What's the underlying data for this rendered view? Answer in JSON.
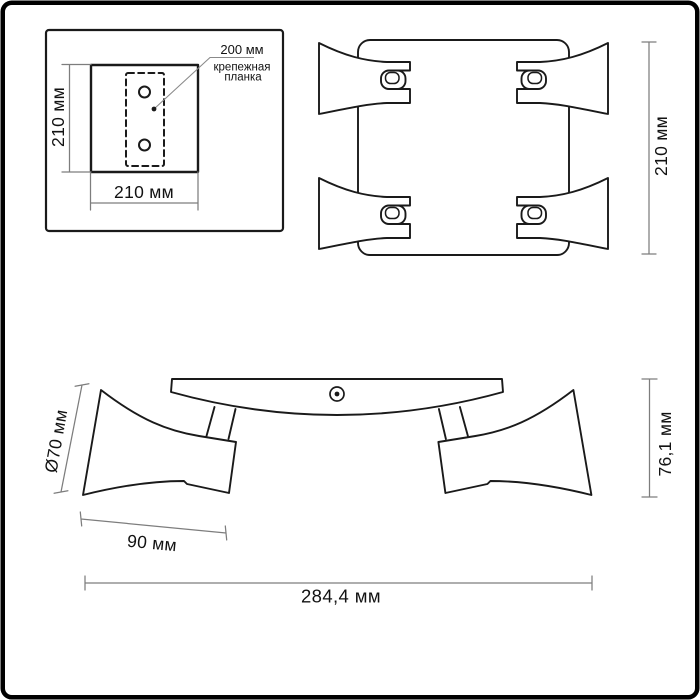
{
  "colors": {
    "background": "#ffffff",
    "drawing_line": "#1a1a1a",
    "dimension_line": "#7d7d7d",
    "text": "#121212",
    "border": "#000000"
  },
  "inset": {
    "height_label": "210 мм",
    "width_label": "210 мм",
    "callout_value": "200 мм",
    "callout_line1": "крепежная",
    "callout_line2": "планка"
  },
  "top_view": {
    "height_label": "210 мм"
  },
  "side_view": {
    "diameter_label": "Ø70 мм",
    "shade_length_label": "90 мм",
    "overall_width_label": "284,4 мм",
    "height_label": "76,1 мм"
  }
}
